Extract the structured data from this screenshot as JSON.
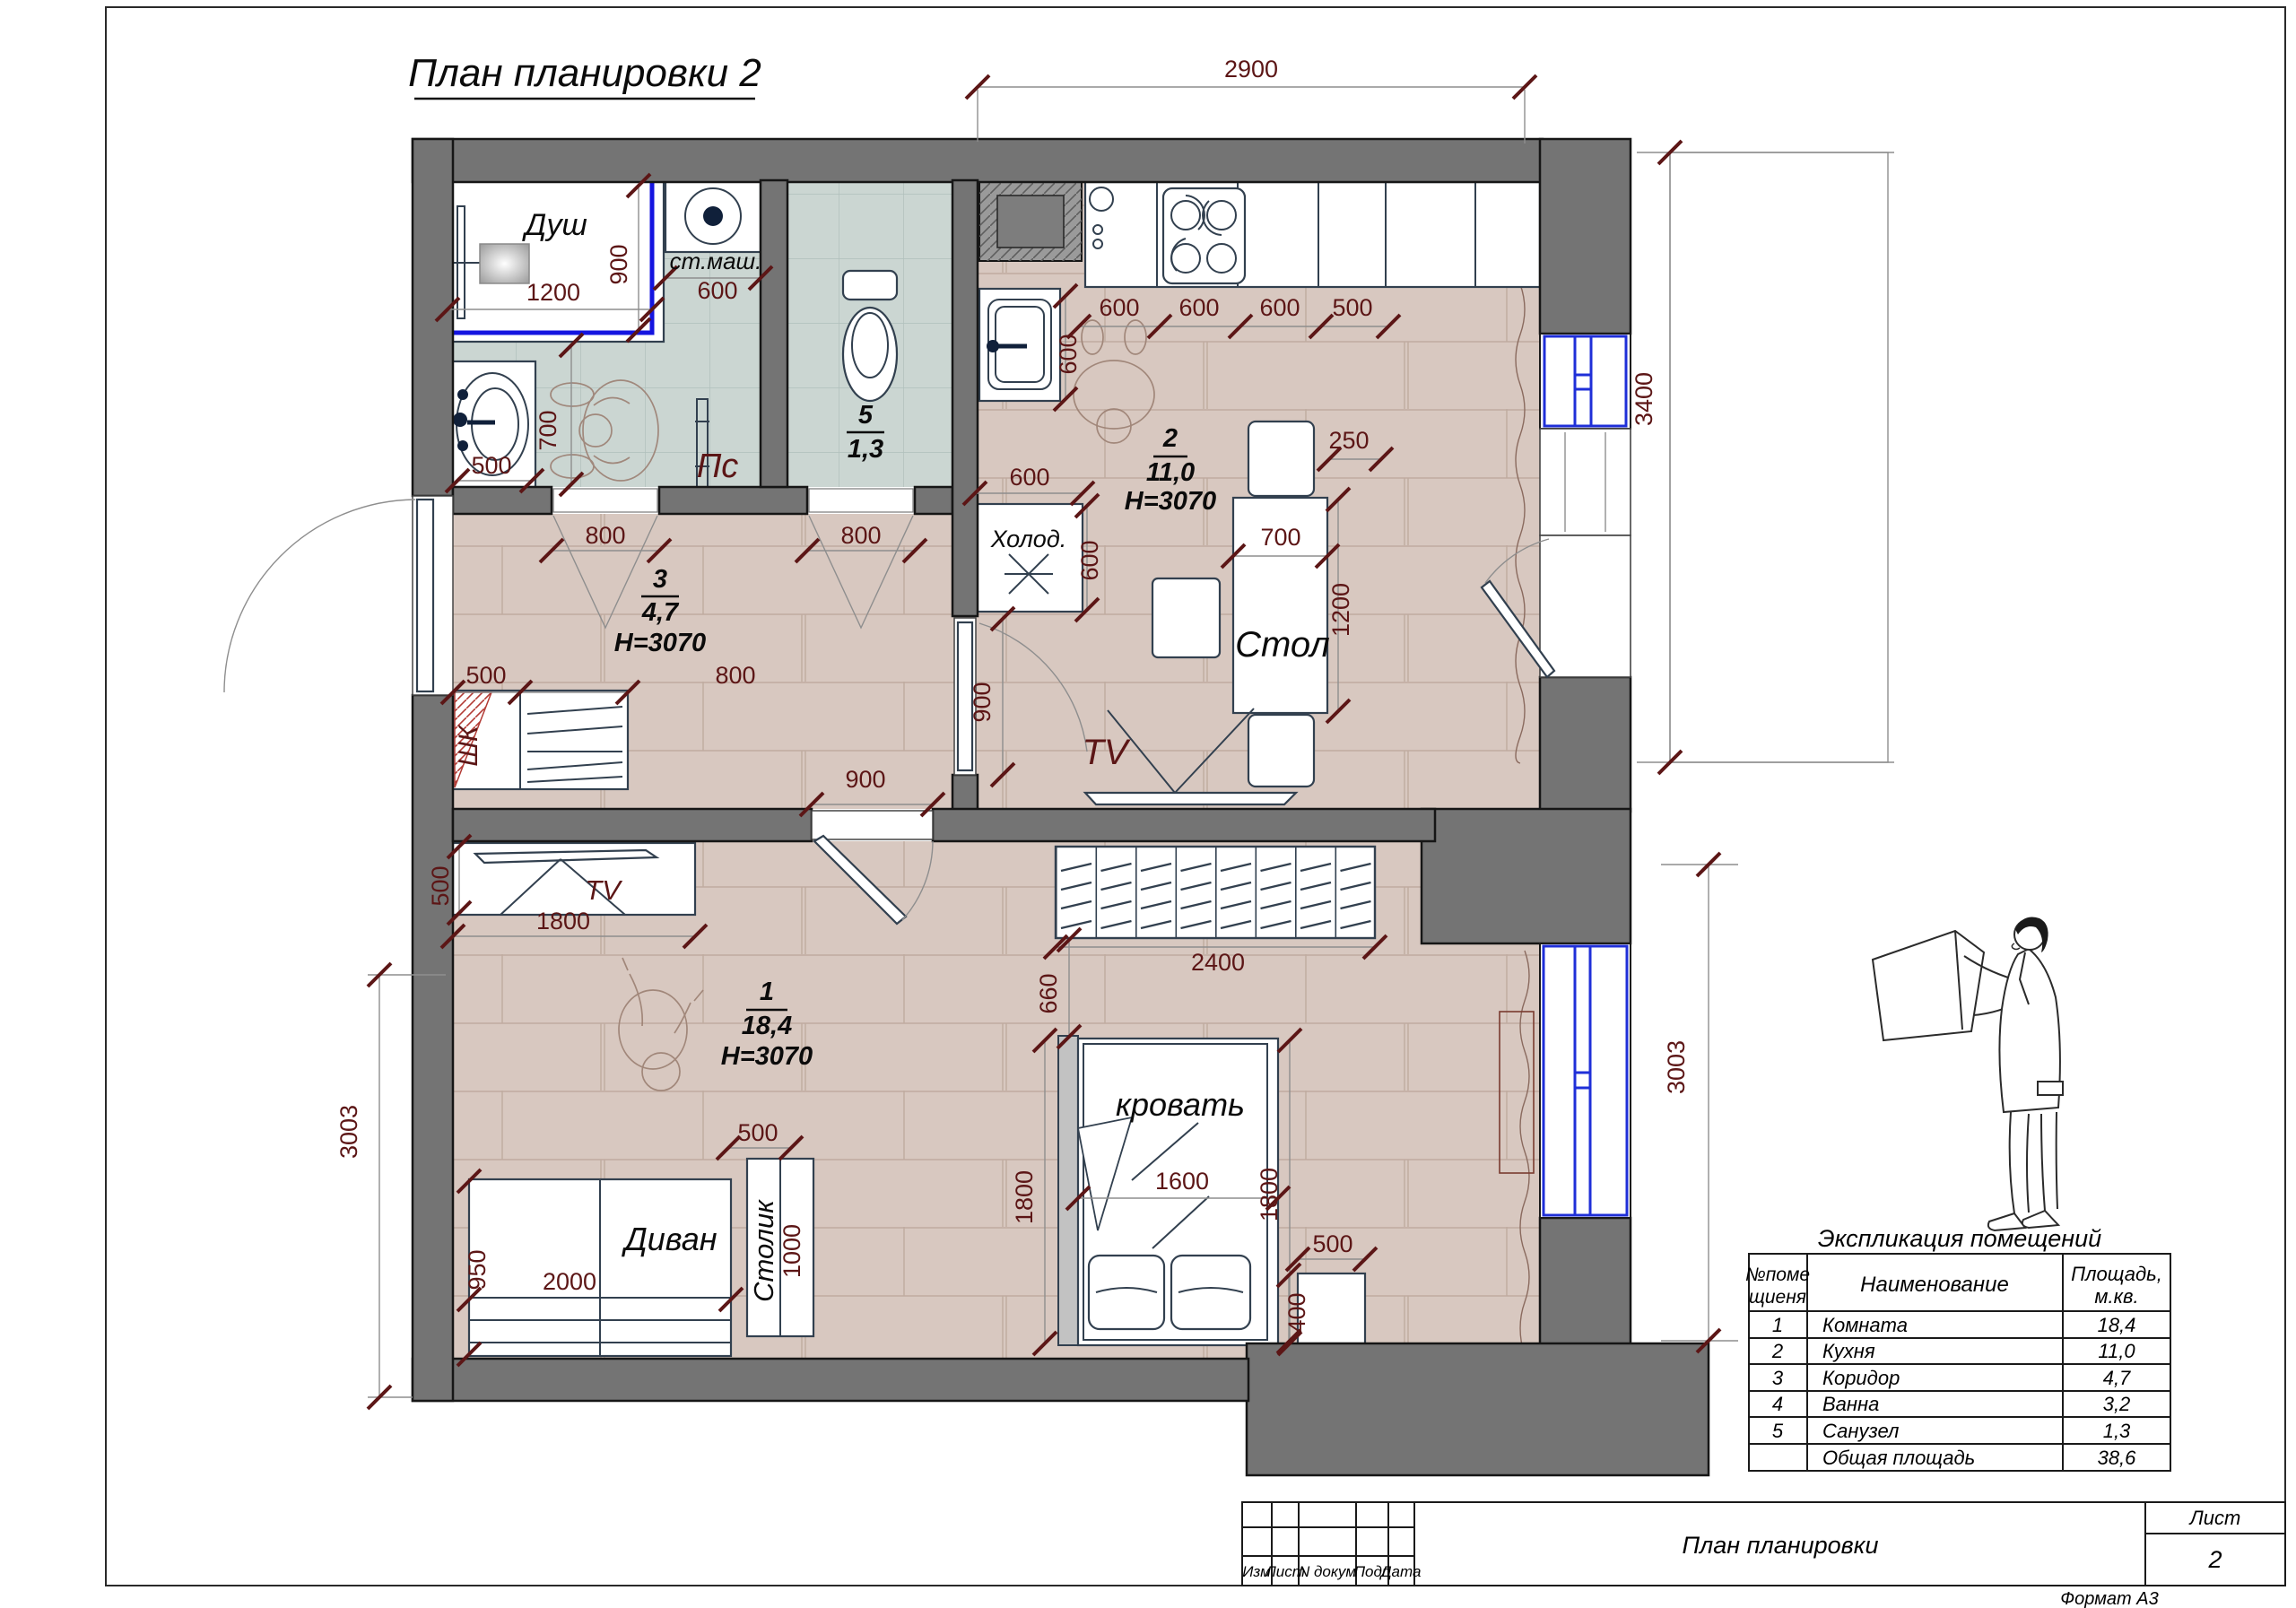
{
  "page": {
    "title": "План планировки 2"
  },
  "colors": {
    "wall": "#747474",
    "dim_text": "#5c1616",
    "window_blue": "#1f2fd8",
    "floor_brick": "#d8c8c0",
    "floor_tile": "#cbd6d2",
    "shower_blue": "#1414e0"
  },
  "rooms": {
    "r1": {
      "num": "1",
      "area": "18,4",
      "h": "H=3070"
    },
    "r2": {
      "num": "2",
      "area": "11,0",
      "h": "H=3070"
    },
    "r3": {
      "num": "3",
      "area": "4,7",
      "h": "H=3070"
    },
    "r5": {
      "num": "5",
      "area": "1,3"
    }
  },
  "labels": {
    "dush": "Душ",
    "stmash": "ст.маш.",
    "ps": "Пс",
    "holod": "Холод.",
    "stol": "Стол",
    "tv": "TV",
    "divan": "Диван",
    "stolik": "Столик",
    "krovat": "кровать",
    "shk": "ШК"
  },
  "dims": {
    "d2900": "2900",
    "d3400": "3400",
    "d3003r": "3003",
    "d3003l": "3003",
    "dush1200": "1200",
    "dush900": "900",
    "stm600": "600",
    "basin500": "500",
    "bath700": "700",
    "door4": "800",
    "door5": "800",
    "shk500": "500",
    "shk800": "800",
    "cor900": "900",
    "kdoor900": "900",
    "c600a": "600",
    "c600b": "600",
    "c600c": "600",
    "c500": "500",
    "c600v": "600",
    "fr600t": "600",
    "fr600r": "600",
    "t700": "700",
    "t1200": "1200",
    "t250": "250",
    "tv500": "500",
    "tv1800": "1800",
    "sofa950": "950",
    "sofa2000": "2000",
    "stolik500": "500",
    "stolik1000": "1000",
    "bed1600": "1600",
    "bed1800l": "1800",
    "bed1800r": "1800",
    "gap660": "660",
    "ns500": "500",
    "ns400": "400",
    "wr2400": "2400"
  },
  "explication": {
    "title": "Экспликация помещений",
    "h1a": "№поме",
    "h1b": "щиеня",
    "h2": "Наименование",
    "h3a": "Площадь,",
    "h3b": "м.кв.",
    "rows": [
      {
        "n": "1",
        "name": "Комната",
        "area": "18,4"
      },
      {
        "n": "2",
        "name": "Кухня",
        "area": "11,0"
      },
      {
        "n": "3",
        "name": "Коридор",
        "area": "4,7"
      },
      {
        "n": "4",
        "name": "Ванна",
        "area": "3,2"
      },
      {
        "n": "5",
        "name": "Санузел",
        "area": "1,3"
      },
      {
        "n": "",
        "name": "Общая площадь",
        "area": "38,6"
      }
    ]
  },
  "titleblock": {
    "izm": "Изм",
    "list": "Лист",
    "ndok": "N докум",
    "podp": "Подп",
    "data": "Дата",
    "doc": "План планировки",
    "sheet_lbl": "Лист",
    "sheet": "2",
    "format": "Формат А3"
  }
}
